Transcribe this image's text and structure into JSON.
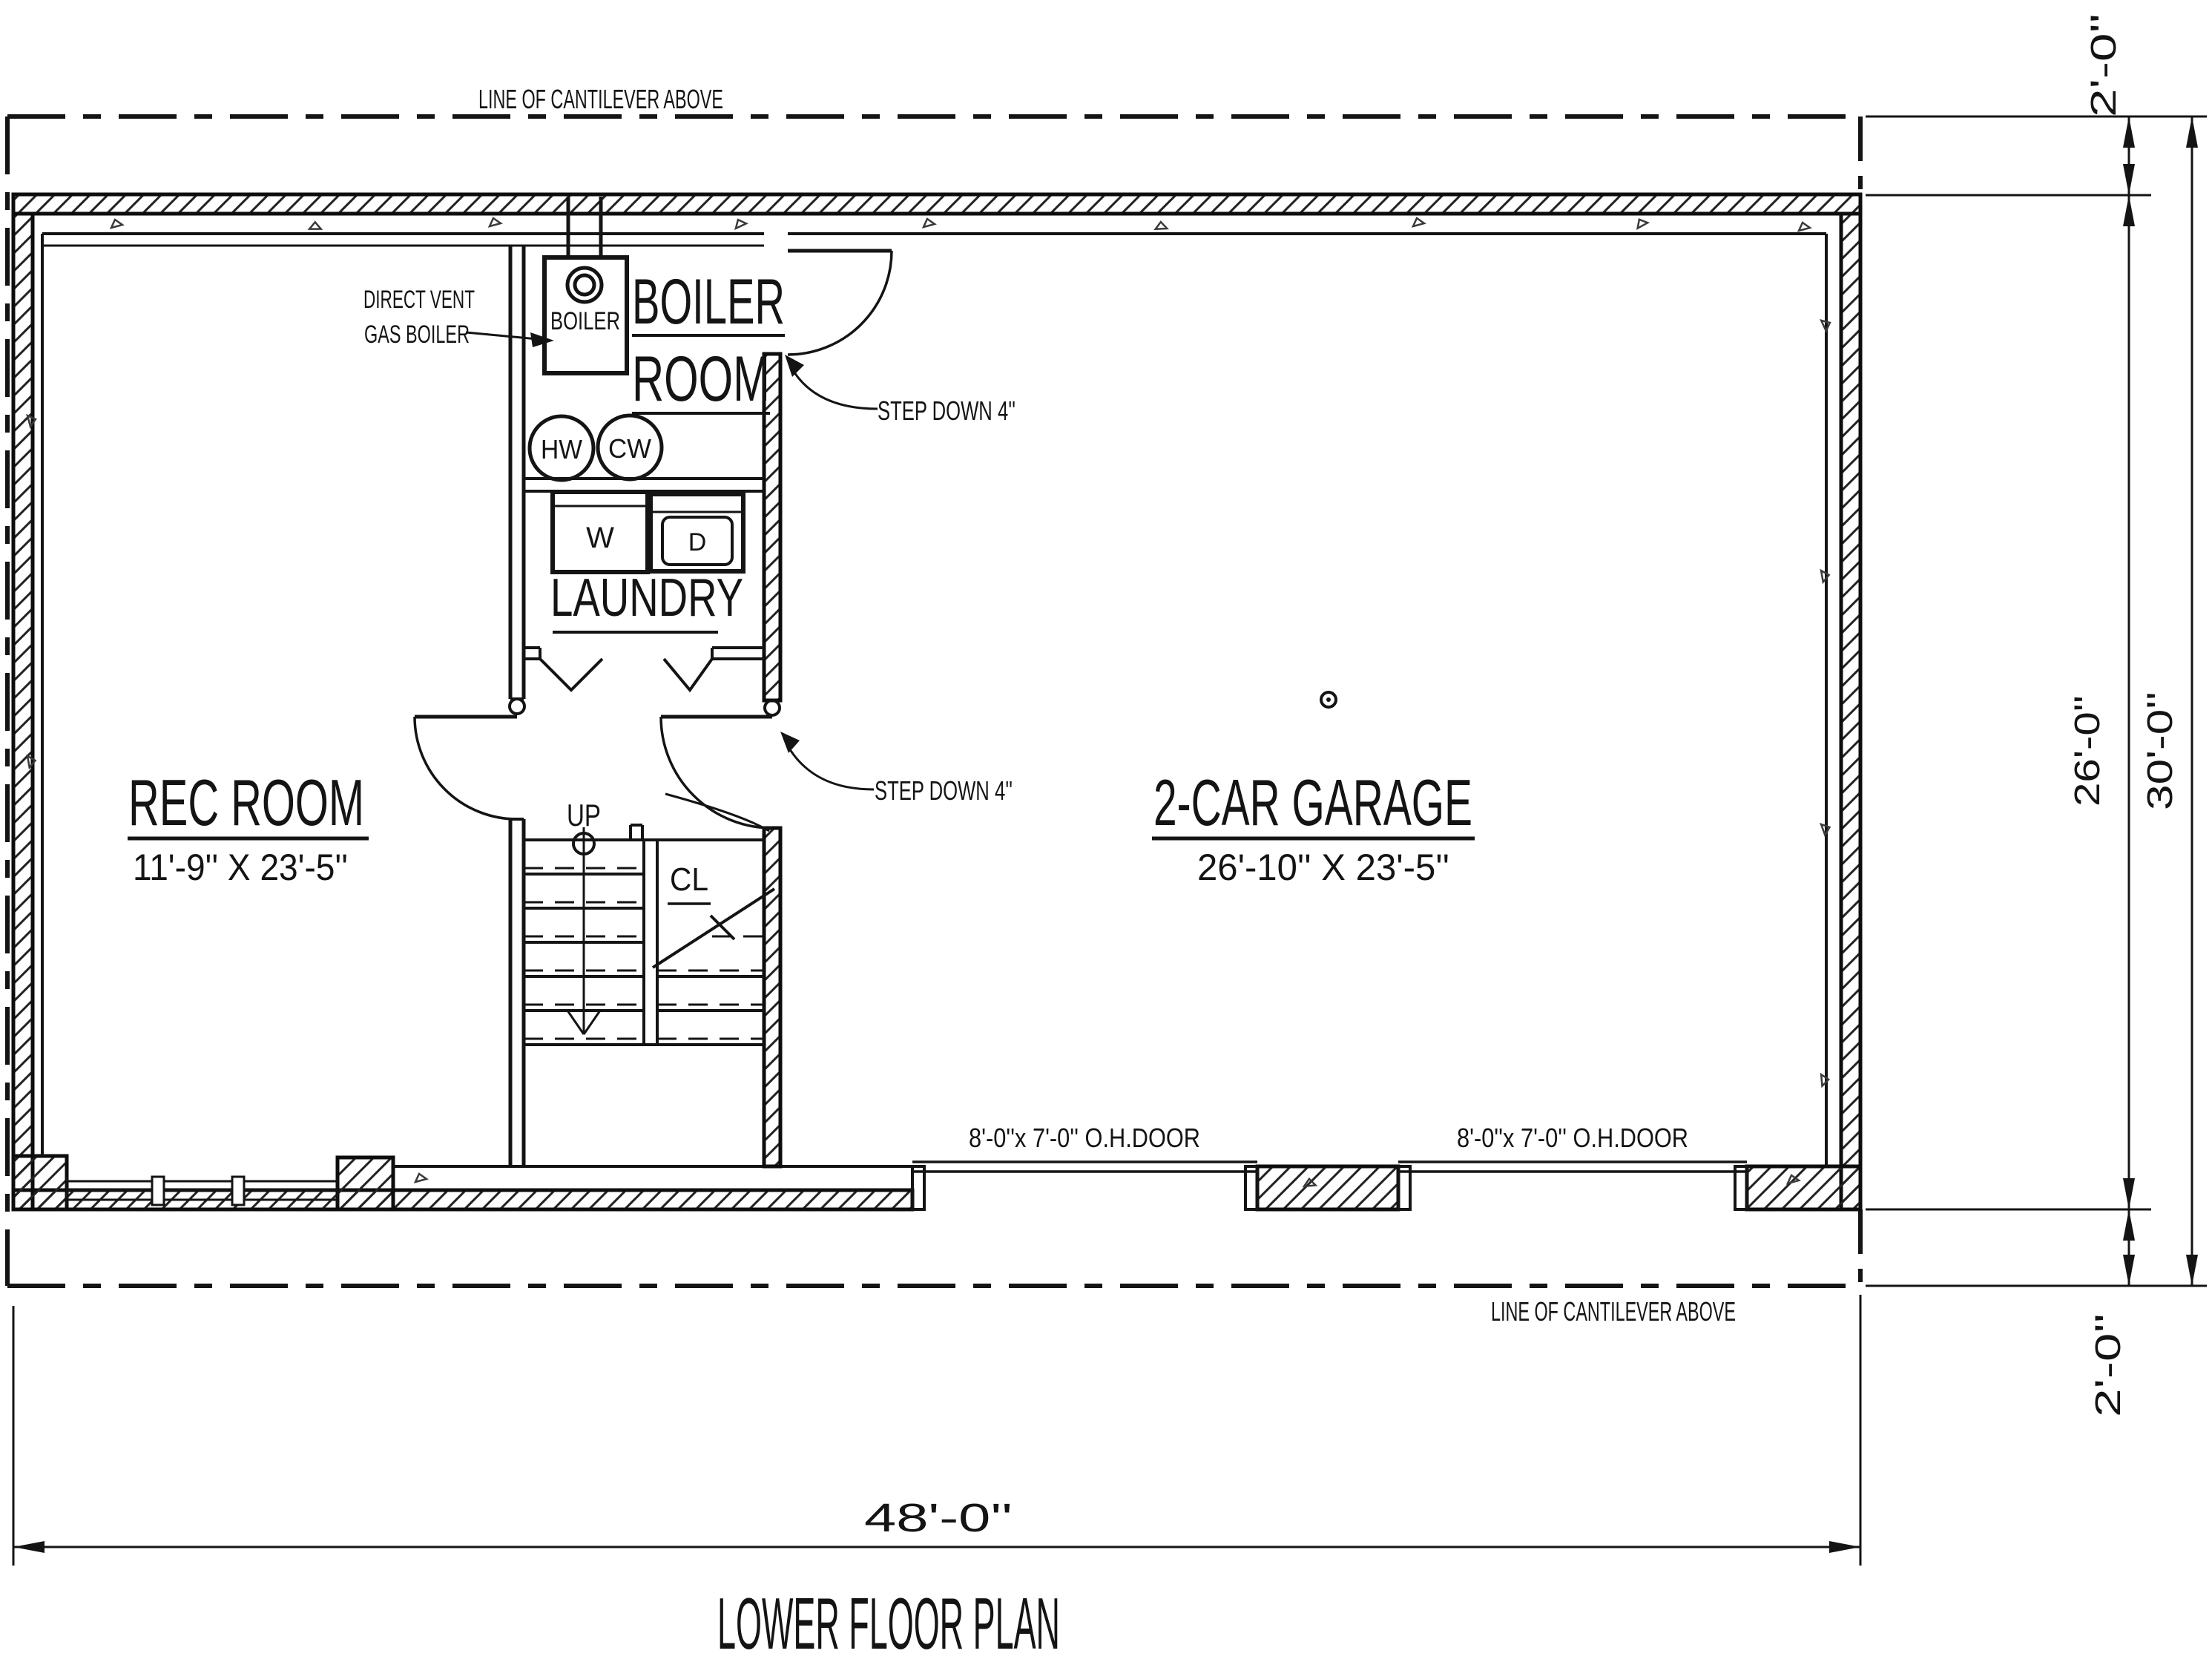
{
  "title": "LOWER FLOOR PLAN",
  "rooms": {
    "rec_room": {
      "name": "REC ROOM",
      "size": "11'-9'' X 23'-5''"
    },
    "garage": {
      "name": "2-CAR GARAGE",
      "size": "26'-10'' X 23'-5''"
    },
    "boiler_room": {
      "line1": "BOILER",
      "line2": "ROOM"
    },
    "laundry": {
      "name": "LAUNDRY"
    },
    "closet": {
      "label": "CL"
    },
    "stair": {
      "label": "UP"
    }
  },
  "equipment": {
    "boiler": "BOILER",
    "hw": "HW",
    "cw": "CW",
    "washer": "W",
    "dryer": "D",
    "boiler_note1": "DIRECT VENT",
    "boiler_note2": "GAS BOILER"
  },
  "annotations": {
    "cantilever_top": "LINE OF CANTILEVER ABOVE",
    "cantilever_bottom": "LINE OF CANTILEVER ABOVE",
    "step_down_boiler": "STEP DOWN 4''",
    "step_down_garage": "STEP DOWN 4''",
    "oh_door_left": "8'-0''x 7'-0'' O.H.DOOR",
    "oh_door_right": "8'-0''x 7'-0'' O.H.DOOR"
  },
  "dimensions": {
    "overall_width": "48'-0''",
    "overall_depth": "30'-0''",
    "main_depth": "26'-0''",
    "cantilever_top": "2'-0''",
    "cantilever_bottom": "2'-0''"
  },
  "colors": {
    "ink": "#141414",
    "paper": "#ffffff"
  }
}
